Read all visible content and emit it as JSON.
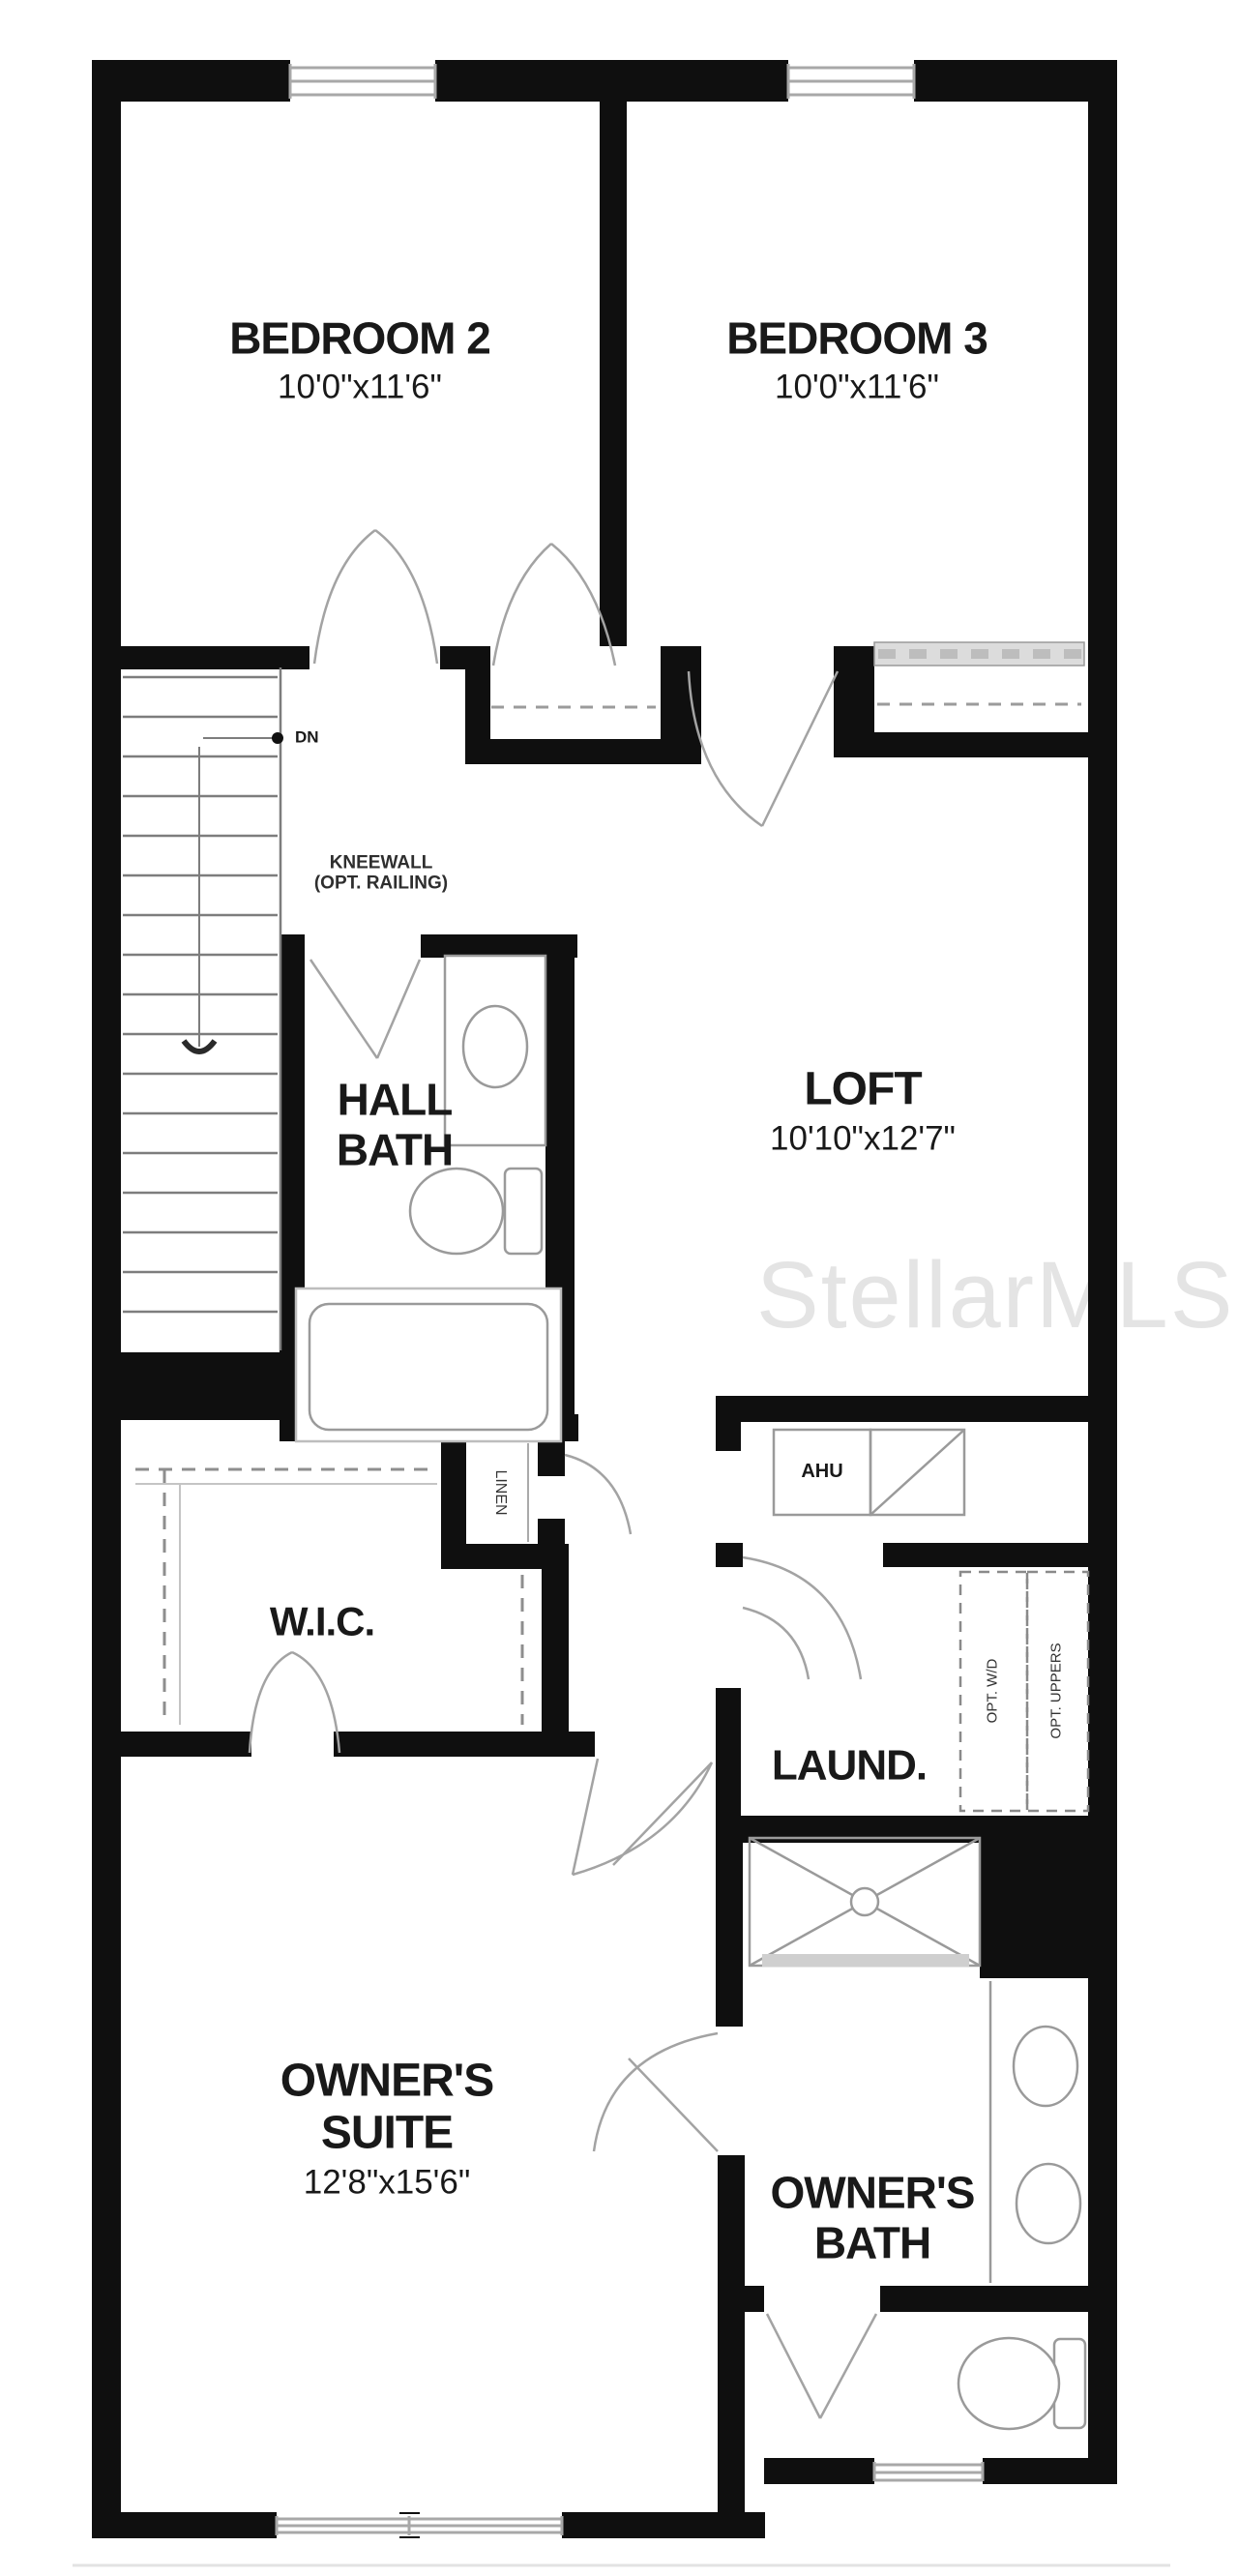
{
  "watermark": "StellarMLS",
  "rooms": {
    "bedroom2": {
      "name": "BEDROOM 2",
      "dims": "10'0\"x11'6\""
    },
    "bedroom3": {
      "name": "BEDROOM 3",
      "dims": "10'0\"x11'6\""
    },
    "loft": {
      "name": "LOFT",
      "dims": "10'10\"x12'7\""
    },
    "hall_bath": {
      "line1": "HALL",
      "line2": "BATH"
    },
    "wic": {
      "name": "W.I.C."
    },
    "laundry": {
      "name": "LAUND."
    },
    "owners_suite": {
      "line1": "OWNER'S",
      "line2": "SUITE",
      "dims": "12'8\"x15'6\""
    },
    "owners_bath": {
      "line1": "OWNER'S",
      "line2": "BATH"
    },
    "linen": {
      "name": "LINEN"
    }
  },
  "annotations": {
    "kneewall_line1": "KNEEWALL",
    "kneewall_line2": "(OPT. RAILING)",
    "dn": "DN",
    "ahu": "AHU",
    "opt_wd": "OPT. W/D",
    "opt_uppers": "OPT. UPPERS"
  },
  "colors": {
    "wall": "#0f0f0f",
    "fixture_line": "#9a9a9a",
    "door_swing": "#a3a3a3",
    "text": "#191919",
    "watermark": "#e4e4e4"
  }
}
